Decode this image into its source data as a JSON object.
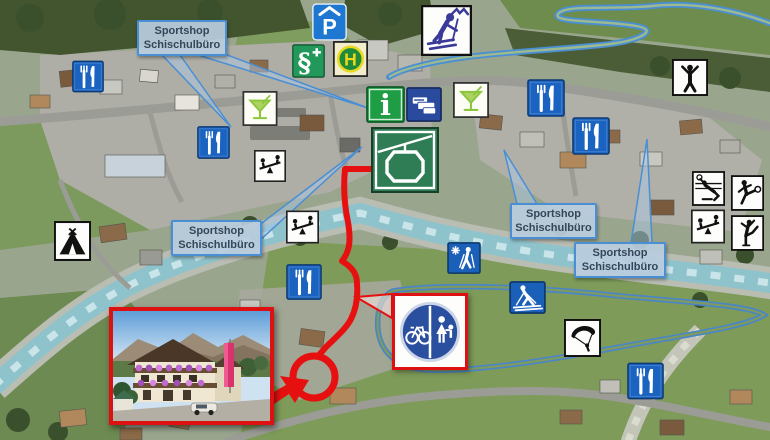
{
  "labels": {
    "sportshop": {
      "line1": "Sportshop",
      "line2": "Schischulbüro"
    }
  },
  "signs": {
    "parking_letter": "P",
    "bus_letter": "H",
    "info_letter": "i",
    "doctor_symbol": "§"
  },
  "icons": {
    "restaurant-icon": "white fork and knife on blue square",
    "cocktail-icon": "green martini glass with straw on white square",
    "playground-icon": "two figures on seesaw, black on white",
    "covered-parking-icon": "white P under roof on blue square",
    "doctor-icon": "white serpent staff and cross on green square",
    "bus-stop-icon": "yellow H in green circle (Haltestelle)",
    "ski-icon": "dark blue downhill skier with mountains on white",
    "info-icon": "white serif i on green square",
    "ticket-office-icon": "white stacked tickets on dark blue square",
    "gondola-icon": "white cable car on green square",
    "gymnastics-icon": "black figure with raised arms on white",
    "volleyball-icon": "diving player with ball on white",
    "soccer-icon": "figure kicking ball on white",
    "ice-skating-icon": "figure-skater pose on white",
    "campsite-icon": "black tent on white",
    "winter-hiking-icon": "snowflake and hiker with poles on blue",
    "cross-country-ski-icon": "white nordic skier on blue",
    "paragliding-icon": "black paraglider canopy and pilot on white",
    "bike-pedestrian-sign": "blue circle, bicycle left, mother and child right",
    "hotel-photo-inset": "alpine guesthouse with flower balconies, pink banner, car"
  },
  "colors": {
    "sign_blue": "#1a63c0",
    "sign_green": "#1f9d44",
    "gondola_green": "#2e7d54",
    "ticket_blue": "#2a4a9e",
    "route_red": "#e61010",
    "route_blue": "#4a8fd4",
    "label_bg": "#bacdde",
    "label_border": "#4a8fd4",
    "river": "#8fc3cc"
  }
}
